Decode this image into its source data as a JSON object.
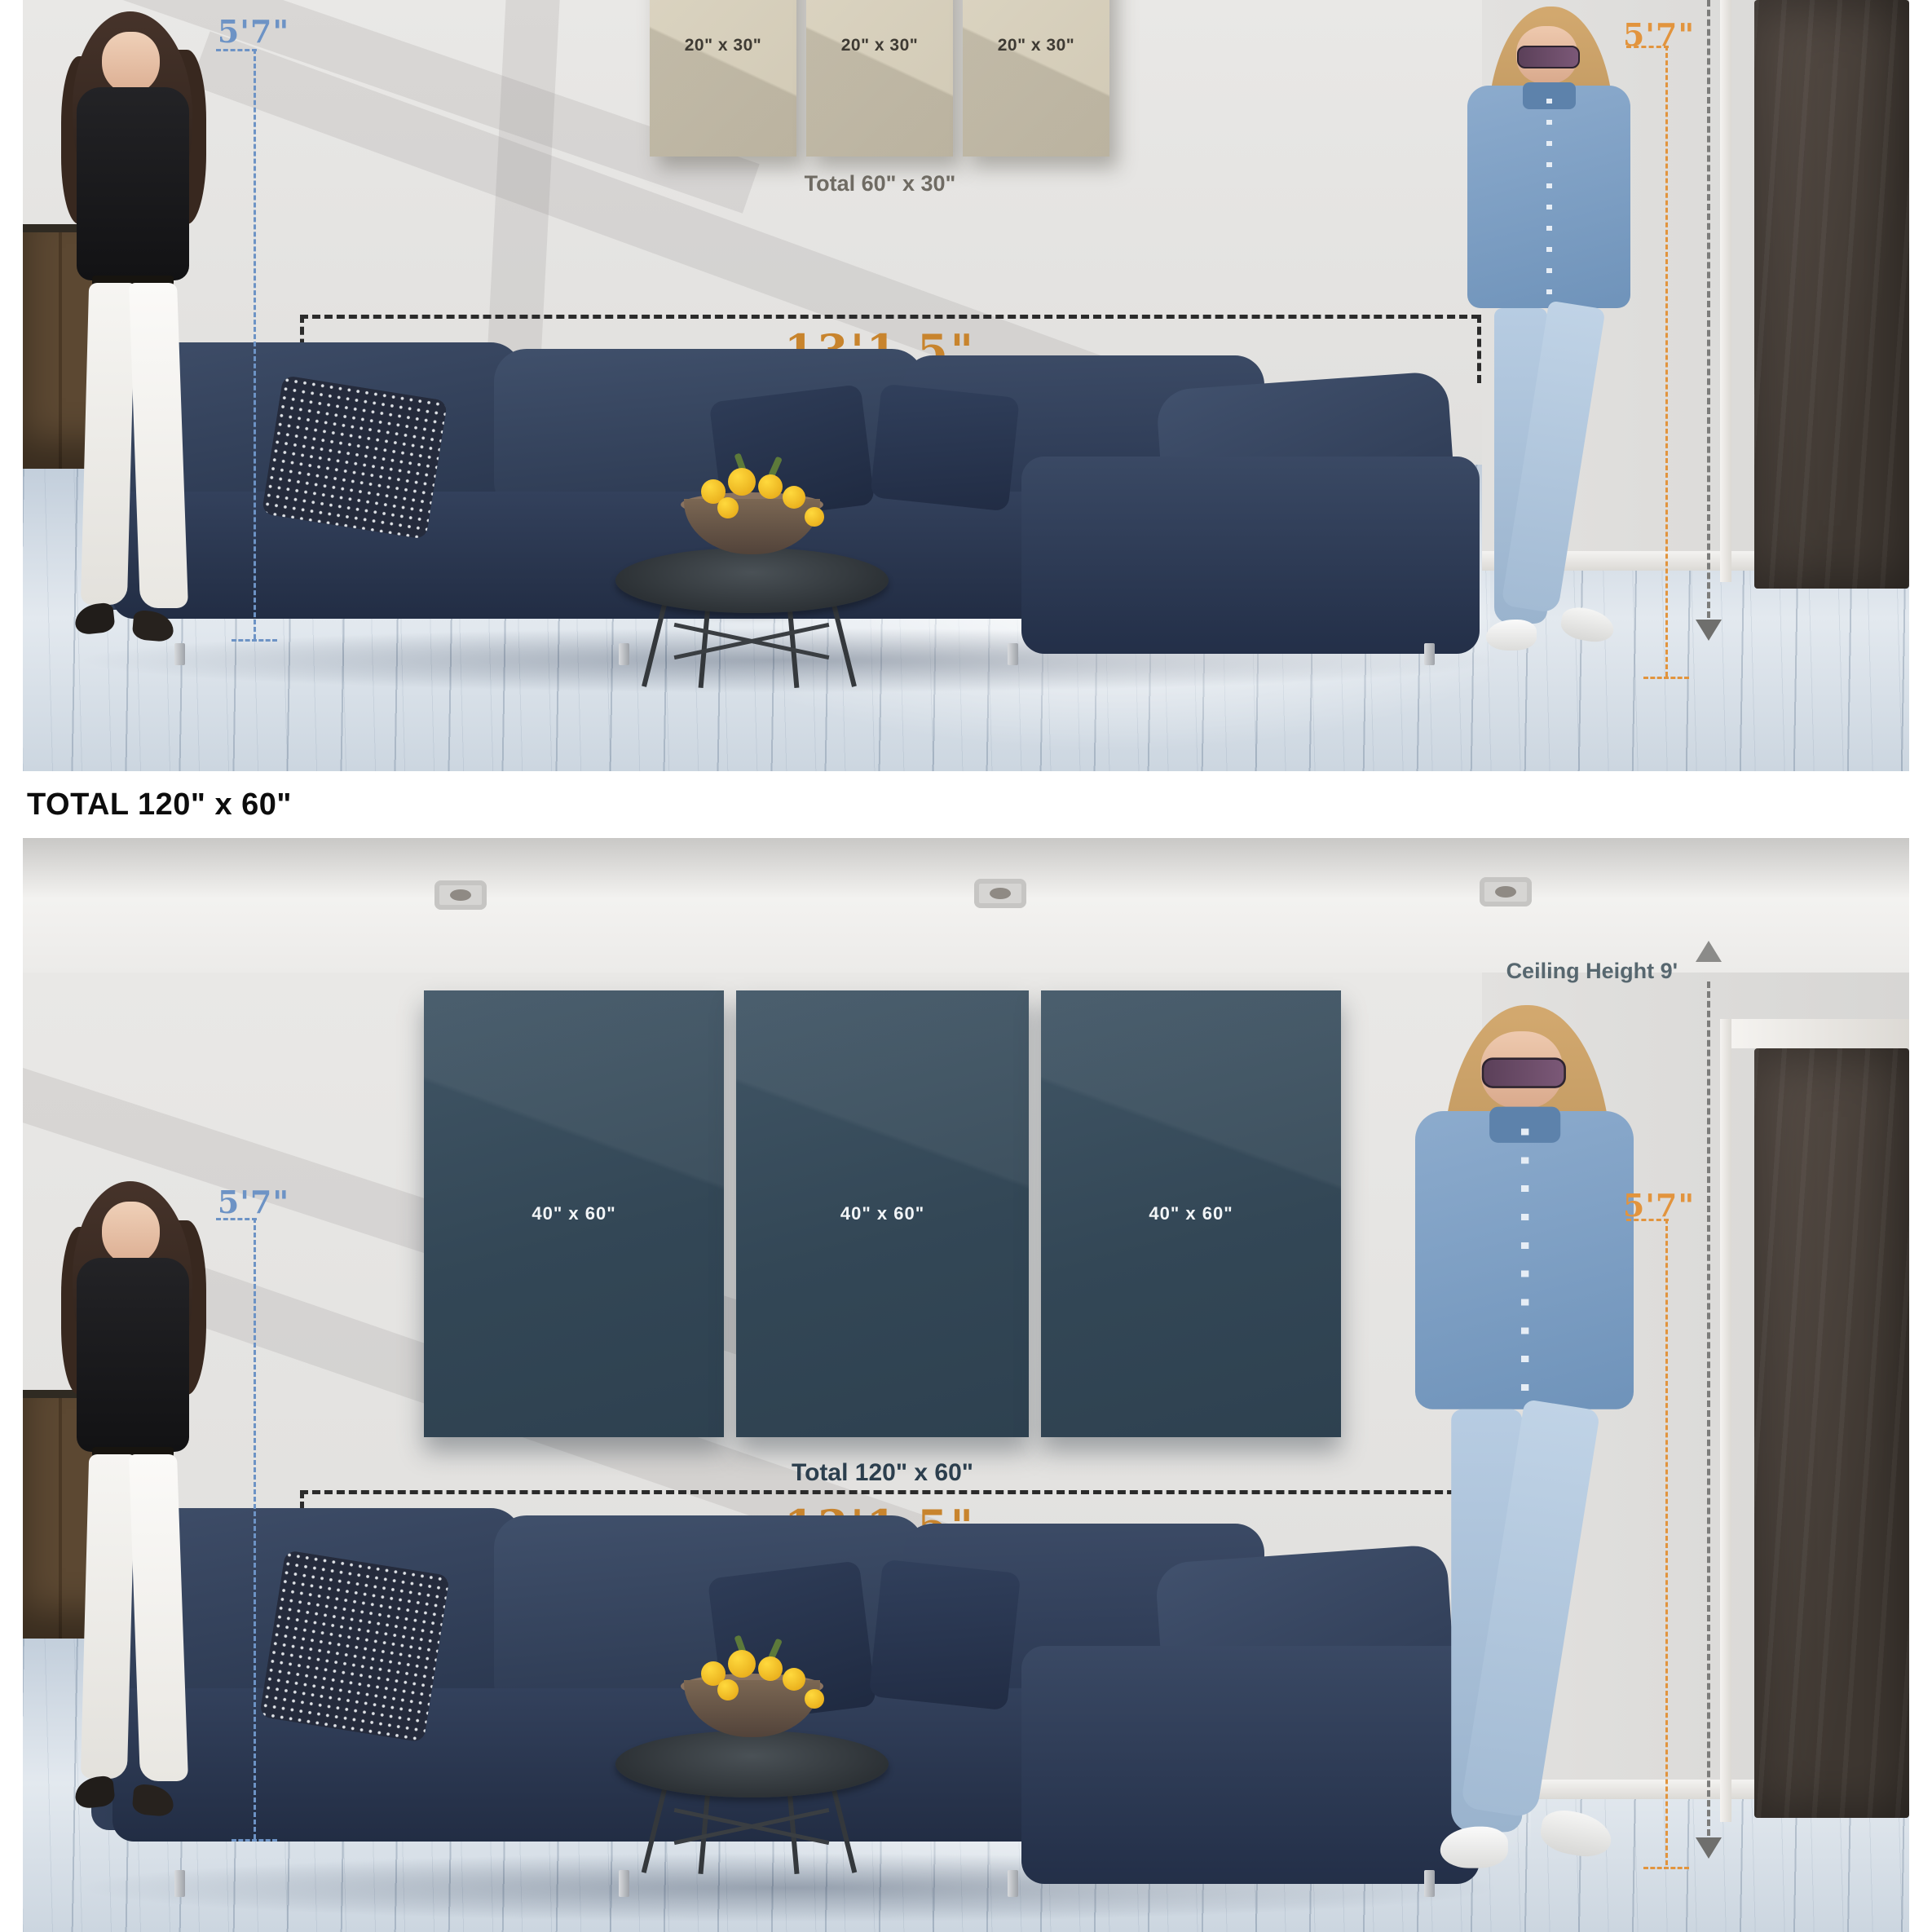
{
  "divider_heading": {
    "label": "TOTAL 120\" x 60\""
  },
  "colors": {
    "height_marker_blue": "#6d93c5",
    "height_marker_orange": "#e2943d",
    "width_label_orange": "#c8842d",
    "beige_canvas": "#d6cfbc",
    "navy_canvas": "#374c5b",
    "measure_dash_black": "#2b2b2b",
    "ceiling_marker_gray": "#7c7c7a"
  },
  "scene_small": {
    "canvases": [
      {
        "label": "20\" x 30\""
      },
      {
        "label": "20\" x 30\""
      },
      {
        "label": "20\" x 30\""
      }
    ],
    "total_label": "Total 60\" x 30\"",
    "sofa_width_label": "13'1.5\"",
    "left_person_height_label": "5'7\"",
    "right_person_height_label": "5'7\""
  },
  "scene_large": {
    "canvases": [
      {
        "label": "40\" x 60\""
      },
      {
        "label": "40\" x 60\""
      },
      {
        "label": "40\" x 60\""
      }
    ],
    "total_label": "Total 120\" x 60\"",
    "sofa_width_label": "13'1.5\"",
    "ceiling_height_label": "Ceiling Height 9'",
    "left_person_height_label": "5'7\"",
    "right_person_height_label": "5'7\""
  }
}
